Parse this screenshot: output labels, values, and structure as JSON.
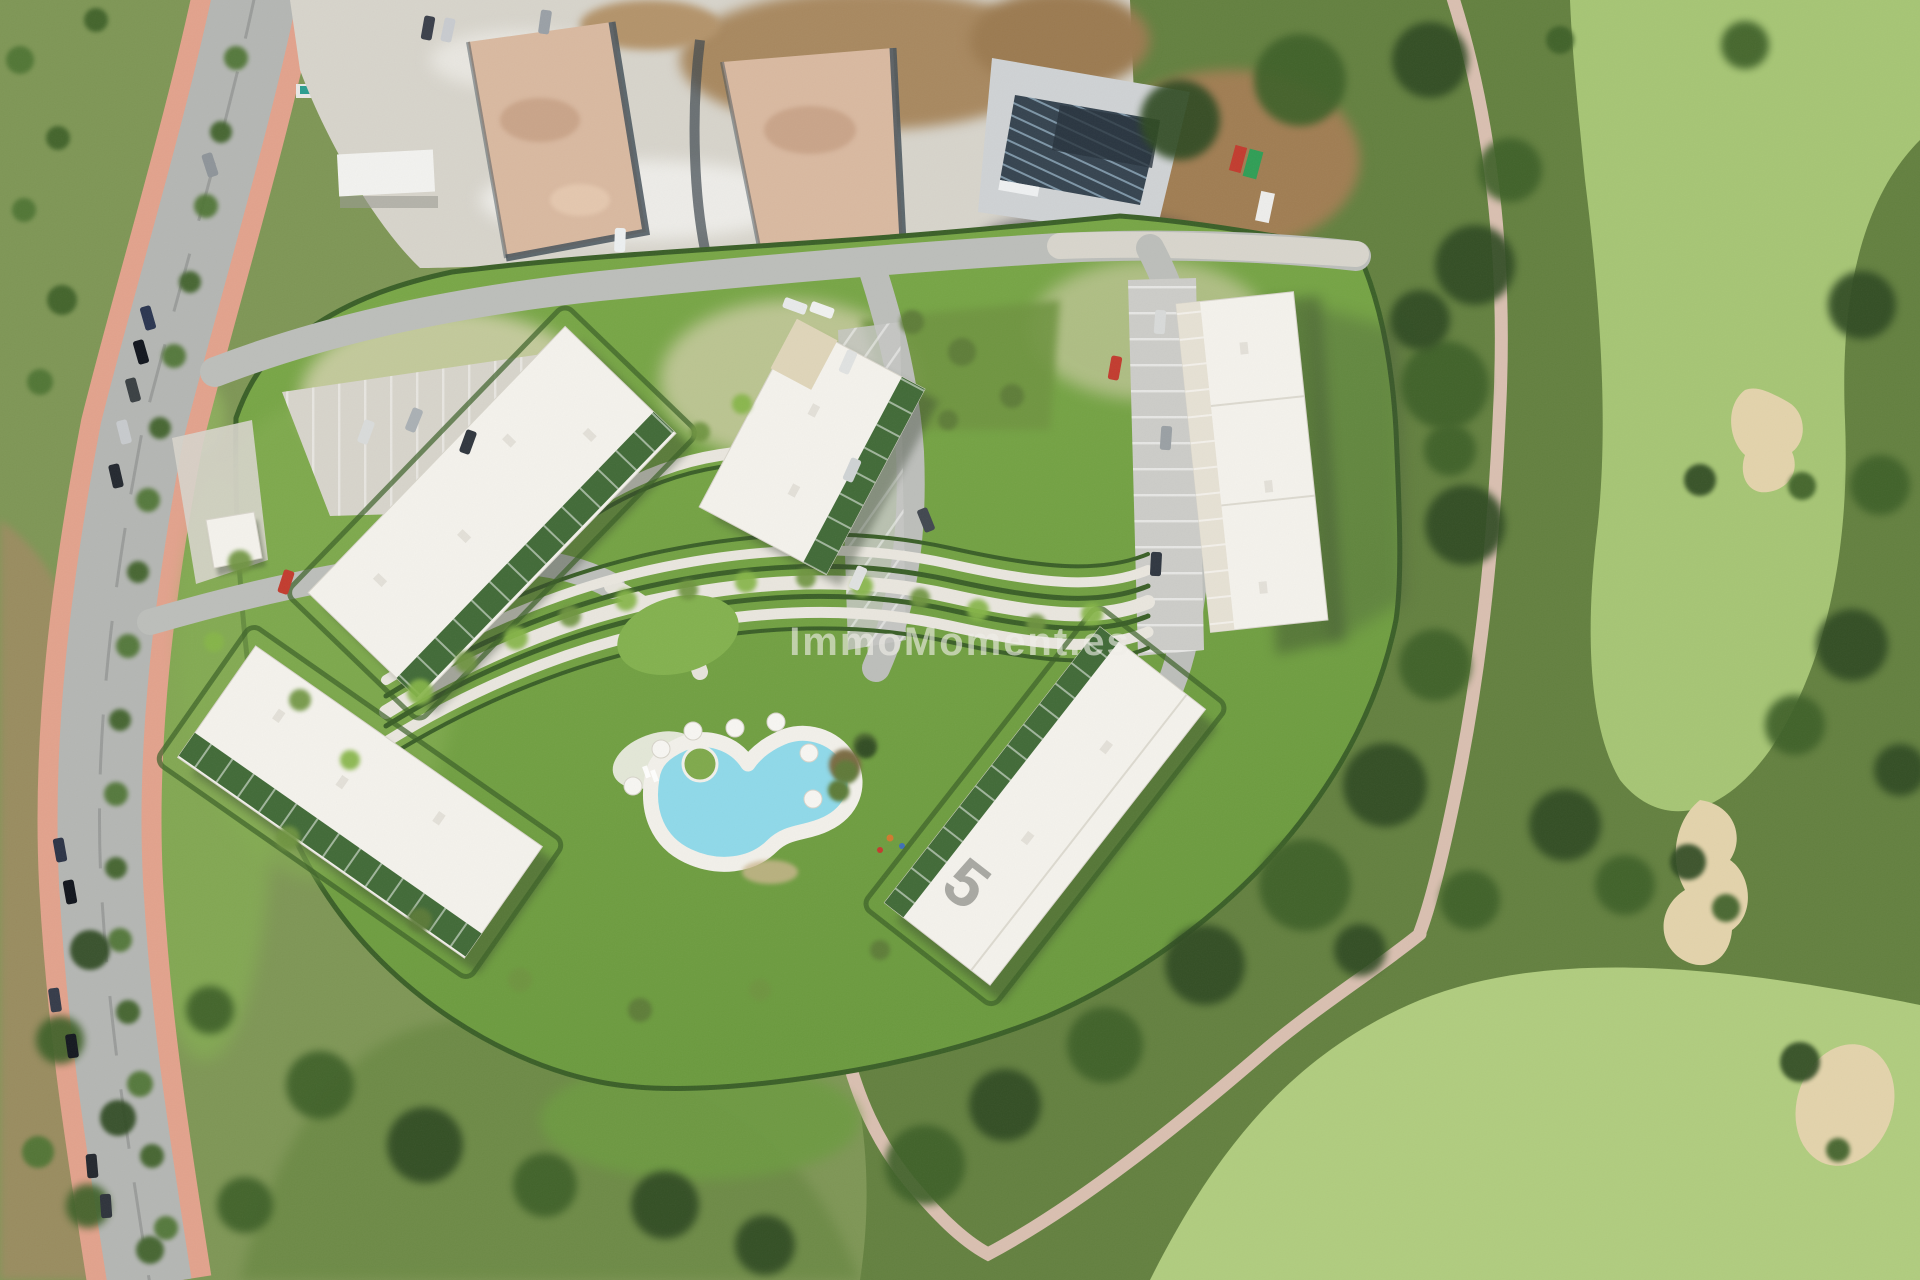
{
  "watermark": {
    "text": "ImmoMoment.es",
    "opacity": 0.62
  },
  "buildings": {
    "roof_label_5": "5",
    "visible_count": 5
  },
  "palette": {
    "scrub": "#7e9655",
    "dense_scrub": "#63803f",
    "meadow": "#84ad52",
    "fairway": "#a6c574",
    "fairway_light": "#b0cc7e",
    "lawn": "#74a43f",
    "hedge": "#3a5f27",
    "roof": "#f4f2ec",
    "path_light": "#e9e6de",
    "asphalt": "#b4b6b3",
    "sidewalk": "#e2a28c",
    "gravel": "#d7d4cb",
    "dirt": "#a8885f",
    "pad": "#d9b9a0",
    "pool": "#8fd9e9",
    "golf_path": "#d9bfb0",
    "sand": "#e3d3ab",
    "shadow": "#303c2a",
    "terrace_green": "#2e5b23",
    "island_green": "#7fa94b",
    "solar_dark": "#35434f",
    "concrete": "#cfd2d4",
    "car_red": "#c23b2e",
    "watermark_color": "#f2f0ea"
  }
}
